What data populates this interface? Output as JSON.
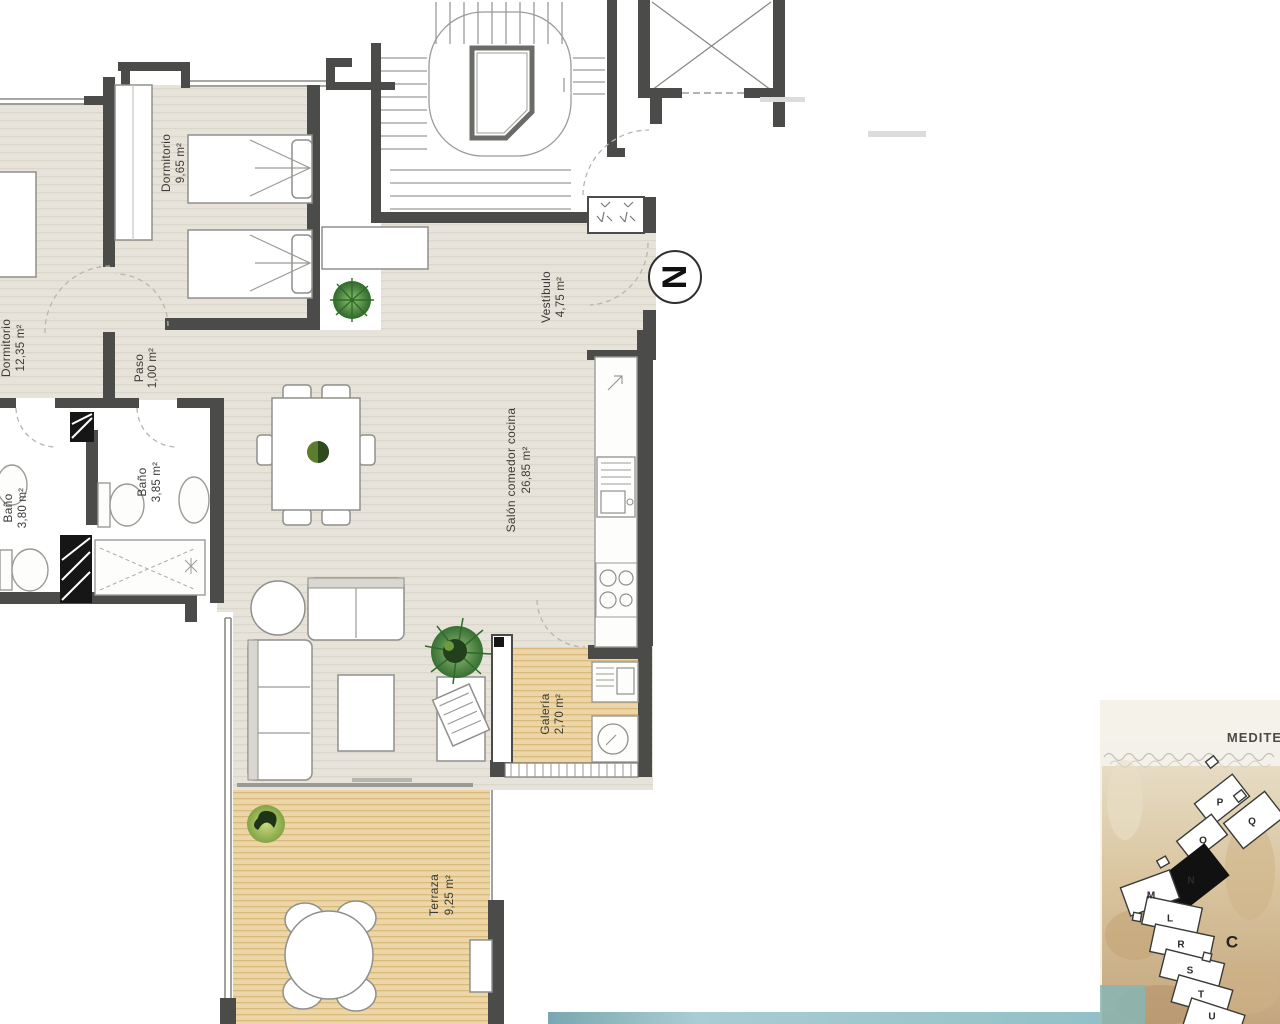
{
  "plan": {
    "rooms": [
      {
        "name": "Dormitorio",
        "area": "9,65 m²"
      },
      {
        "name": "Dormitorio",
        "area": "12,35 m²"
      },
      {
        "name": "Paso",
        "area": "1,00 m²"
      },
      {
        "name": "Baño",
        "area": "3,80 m²"
      },
      {
        "name": "Baño",
        "area": "3,85 m²"
      },
      {
        "name": "Vestíbulo",
        "area": "4,75 m²"
      },
      {
        "name": "Salón comedor cocina",
        "area": "26,85 m²"
      },
      {
        "name": "Galería",
        "area": "2,70 m²"
      },
      {
        "name": "Terraza",
        "area": "9,25 m²"
      }
    ],
    "compass_letter": "N"
  },
  "sitemap": {
    "sea_label": "MEDITE",
    "area_label": "C",
    "highlighted_block": "N",
    "blocks": [
      "P",
      "Q",
      "O",
      "N",
      "M",
      "L",
      "R",
      "S",
      "T",
      "U"
    ]
  },
  "colors": {
    "wall": "#4b4b49",
    "floor": "#e7e3da",
    "wood": "#ecd6a8",
    "wood_line": "#d9b97c",
    "teal_strip": "#8fbfc6",
    "sand": "#d9c49e",
    "plant_green": "#4c8040",
    "highlighted_block_fill": "#111111"
  }
}
